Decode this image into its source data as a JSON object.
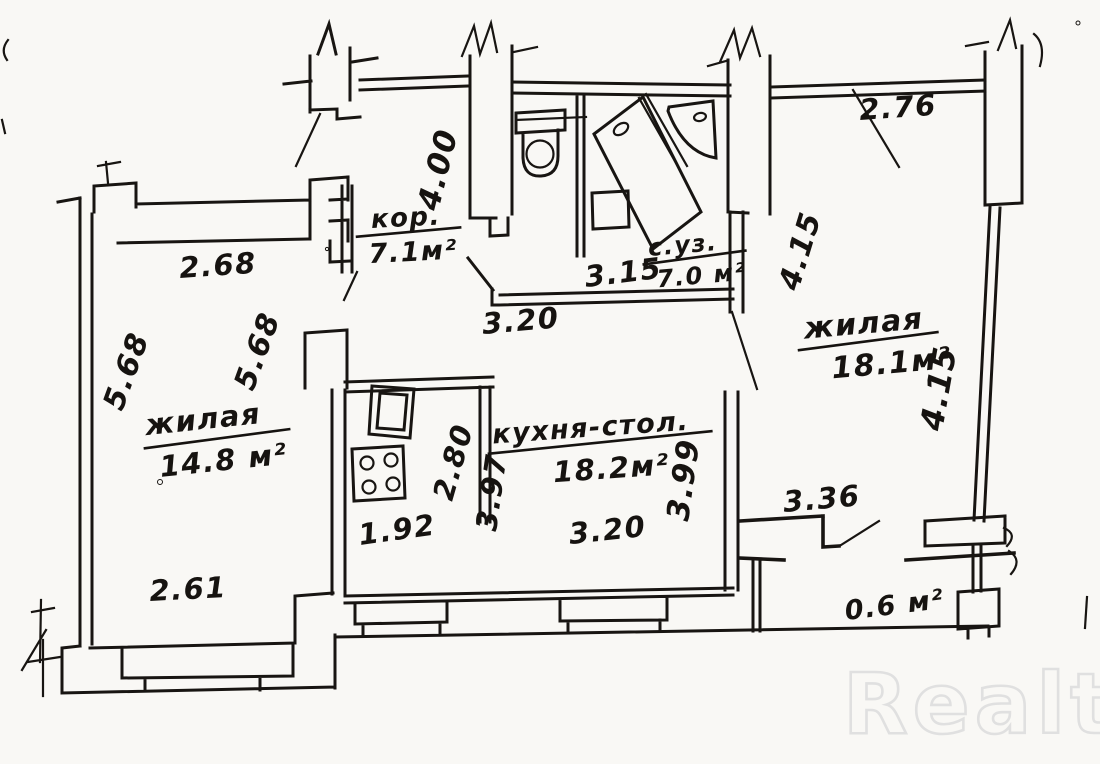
{
  "watermark": "Realt",
  "colors": {
    "ink": "#181512",
    "paper": "#f9f8f5",
    "watermark_outline": "#e0e0e0"
  },
  "rooms": {
    "corridor": {
      "name": "кор.",
      "area": "7.1м²"
    },
    "bathroom": {
      "name": "с.уз.",
      "area": "7.0 м²"
    },
    "living_right": {
      "name": "жилая",
      "area": "18.1м²"
    },
    "living_left": {
      "name": "жилая",
      "area": "14.8 м²"
    },
    "kitchen": {
      "name": "кухня-стол.",
      "area": "18.2м²"
    },
    "balcony": {
      "area": "0.6 м²"
    }
  },
  "dims": {
    "d268": "2.68",
    "d568_left": "5.68",
    "d568_right": "5.68",
    "d261": "2.61",
    "d400": "4.00",
    "d320_hall": "3.20",
    "d315": "3.15",
    "d276": "2.76",
    "d415_left": "4.15",
    "d415_right": "4.15",
    "d280": "2.80",
    "d397": "3.97",
    "d399": "3.99",
    "d192": "1.92",
    "d320_kitchen": "3.20",
    "d336": "3.36"
  }
}
